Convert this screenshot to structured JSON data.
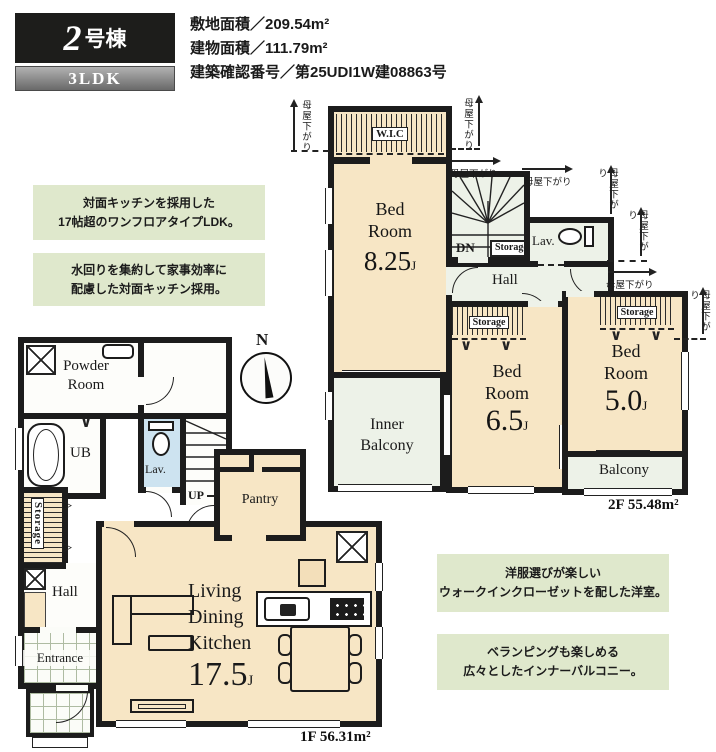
{
  "header": {
    "building_no": "2",
    "building_suffix": "号棟",
    "plan_type": "3LDK",
    "site_area": "敷地面積／209.54m²",
    "building_area": "建物面積／111.79m²",
    "confirmation_no": "建築確認番号／第25UDI1W建08863号"
  },
  "notes": {
    "n1a": "対面キッチンを採用した",
    "n1b": "17帖超のワンフロアタイプLDK。",
    "n2a": "水回りを集約して家事効率に",
    "n2b": "配慮した対面キッチン採用。",
    "n3a": "洋服選びが楽しい",
    "n3b": "ウォークインクローゼットを配した洋室。",
    "n4a": "ベランピングも楽しめる",
    "n4b": "広々としたインナーバルコニー。"
  },
  "common": {
    "moya": "母屋下がり",
    "north": "N",
    "up": "UP",
    "dn": "DN",
    "storage": "Storage",
    "hall": "Hall",
    "lav": "Lav.",
    "bed_line1": "Bed",
    "bed_line2": "Room",
    "jo": "J"
  },
  "f2": {
    "area_label": "2F 55.48m²",
    "wic": "W.I.C",
    "bed1_size": "8.25",
    "bed2_size": "6.5",
    "bed3_size": "5.0",
    "inner_balcony_line1": "Inner",
    "inner_balcony_line2": "Balcony",
    "balcony": "Balcony"
  },
  "f1": {
    "area_label": "1F 56.31m²",
    "powder_line1": "Powder",
    "powder_line2": "Room",
    "ub": "UB",
    "entrance": "Entrance",
    "pantry": "Pantry",
    "ldk_line1": "Living",
    "ldk_line2": "Dining",
    "ldk_line3": "Kitchen",
    "ldk_size": "17.5"
  },
  "colors": {
    "wall": "#1c1c1c",
    "room_beige": "#f7e6c5",
    "balcony_green": "#edf2e8",
    "lav_blue": "#cde3f0",
    "note_green": "#dfe8cc",
    "badge_black": "#1d1d1b"
  }
}
